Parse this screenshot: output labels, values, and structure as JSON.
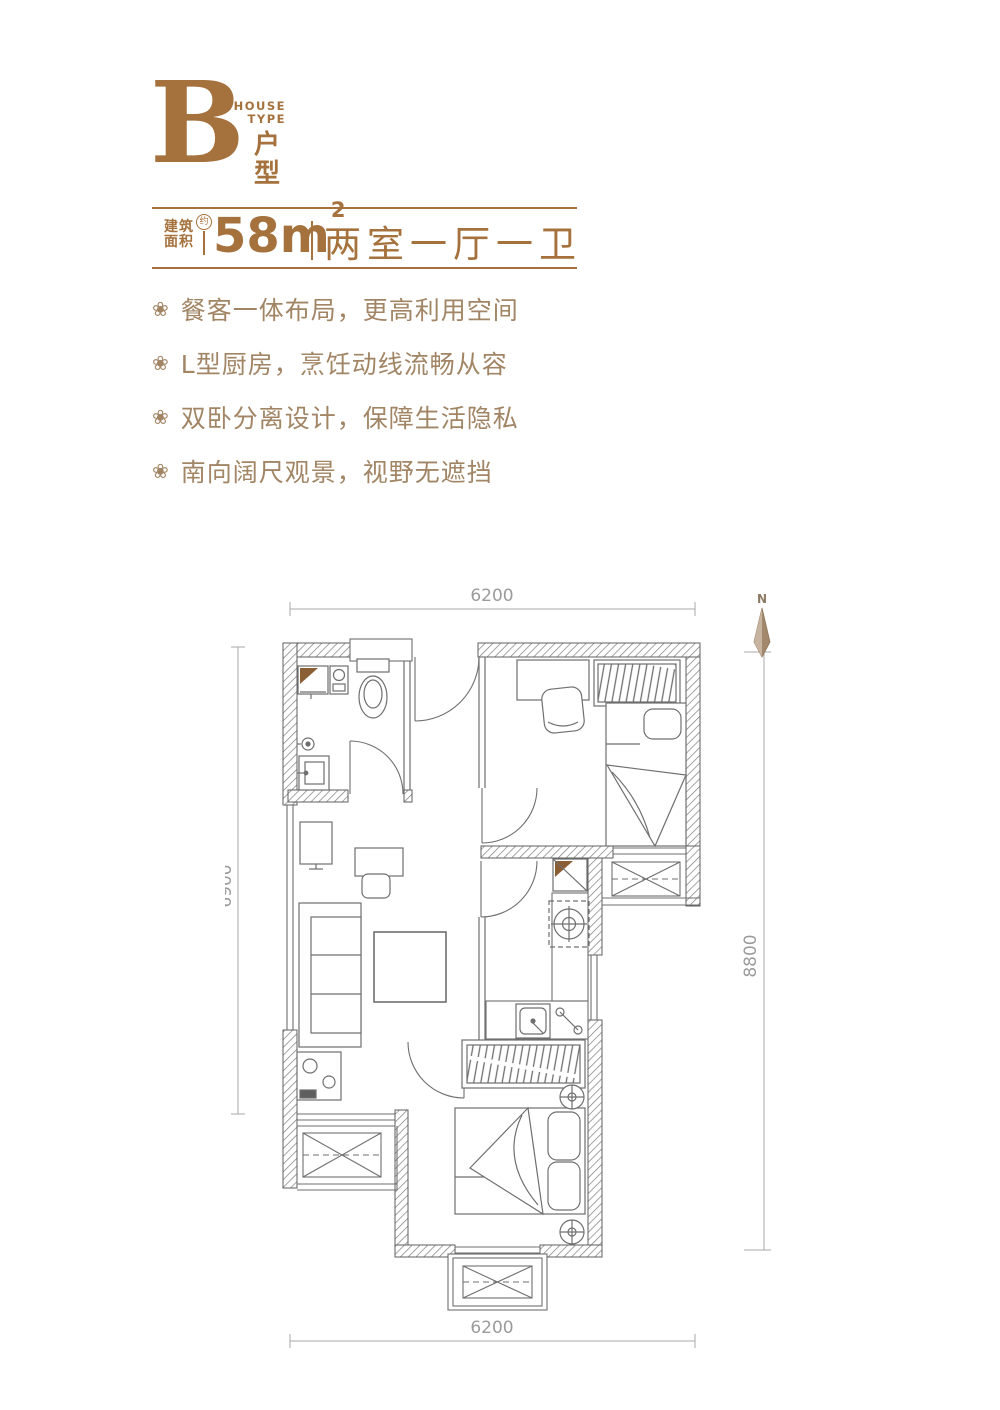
{
  "header": {
    "type_letter": "B",
    "house_type_en": [
      "HOUSE",
      "TYPE"
    ],
    "house_type_cn": "户型",
    "area_label": [
      "建筑",
      "面积"
    ],
    "area_approx": "约",
    "area_value": "58",
    "area_unit": "m",
    "area_exponent": "2",
    "layout_text": "两室一厅一卫"
  },
  "icons": {
    "bullet": "❀"
  },
  "features": [
    "餐客一体布局，更高利用空间",
    "L型厨房，烹饪动线流畅从容",
    "双卧分离设计，保障生活隐私",
    "南向阔尺观景，视野无遮挡"
  ],
  "floorplan": {
    "north_label": "N",
    "dimensions": {
      "top": "6200",
      "left": "6900",
      "right": "8800",
      "bottom": "6200"
    }
  },
  "colors": {
    "brand_brown": "#a5713c",
    "feature_text": "#a28565",
    "plan_line": "#6f6f6f",
    "wall_edge": "#5f5f5f",
    "dim_text": "#9b9b9b",
    "north_fill": "#a3886c"
  }
}
